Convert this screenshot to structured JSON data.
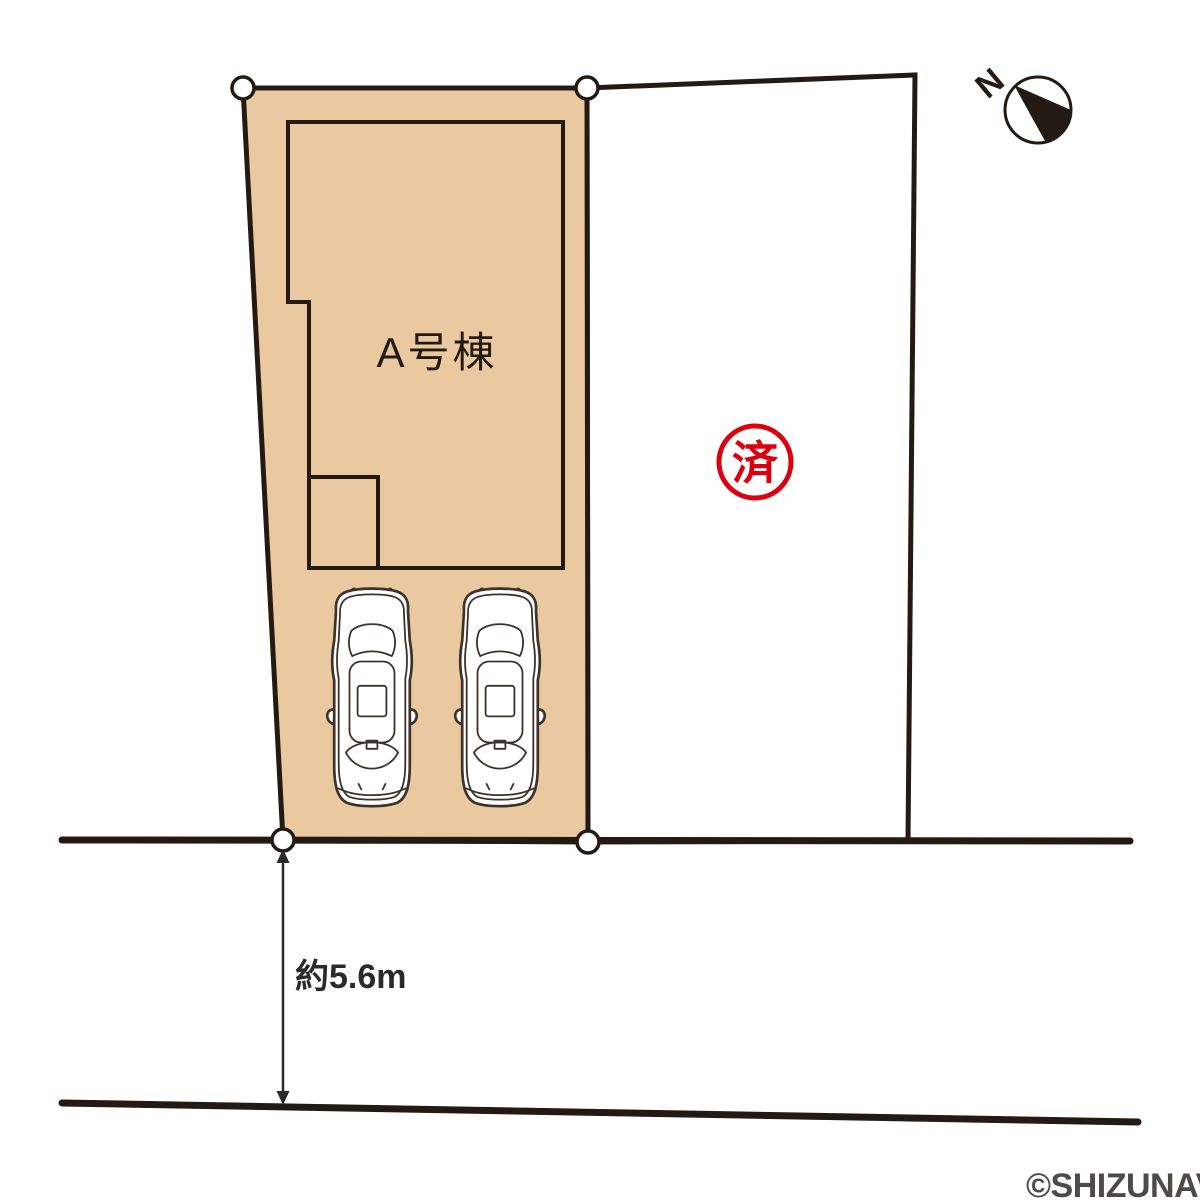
{
  "plan": {
    "building_label": "A号棟",
    "sold_stamp": "済",
    "front_road_dimension": "約5.6m",
    "compass_north": "N",
    "copyright": "©SHIZUNAVI"
  },
  "icons": {
    "compass": "north-compass-icon",
    "cars": "car-top-view-icon",
    "vertices": "boundary-vertex-marker"
  },
  "colors": {
    "parcel_fill": "#eac9a0",
    "line": "#241a14",
    "stamp_red": "#dc000f",
    "dimension": "#2a2a2a",
    "copyright_gray": "#4d4a48",
    "car_outline": "#3c322b"
  }
}
